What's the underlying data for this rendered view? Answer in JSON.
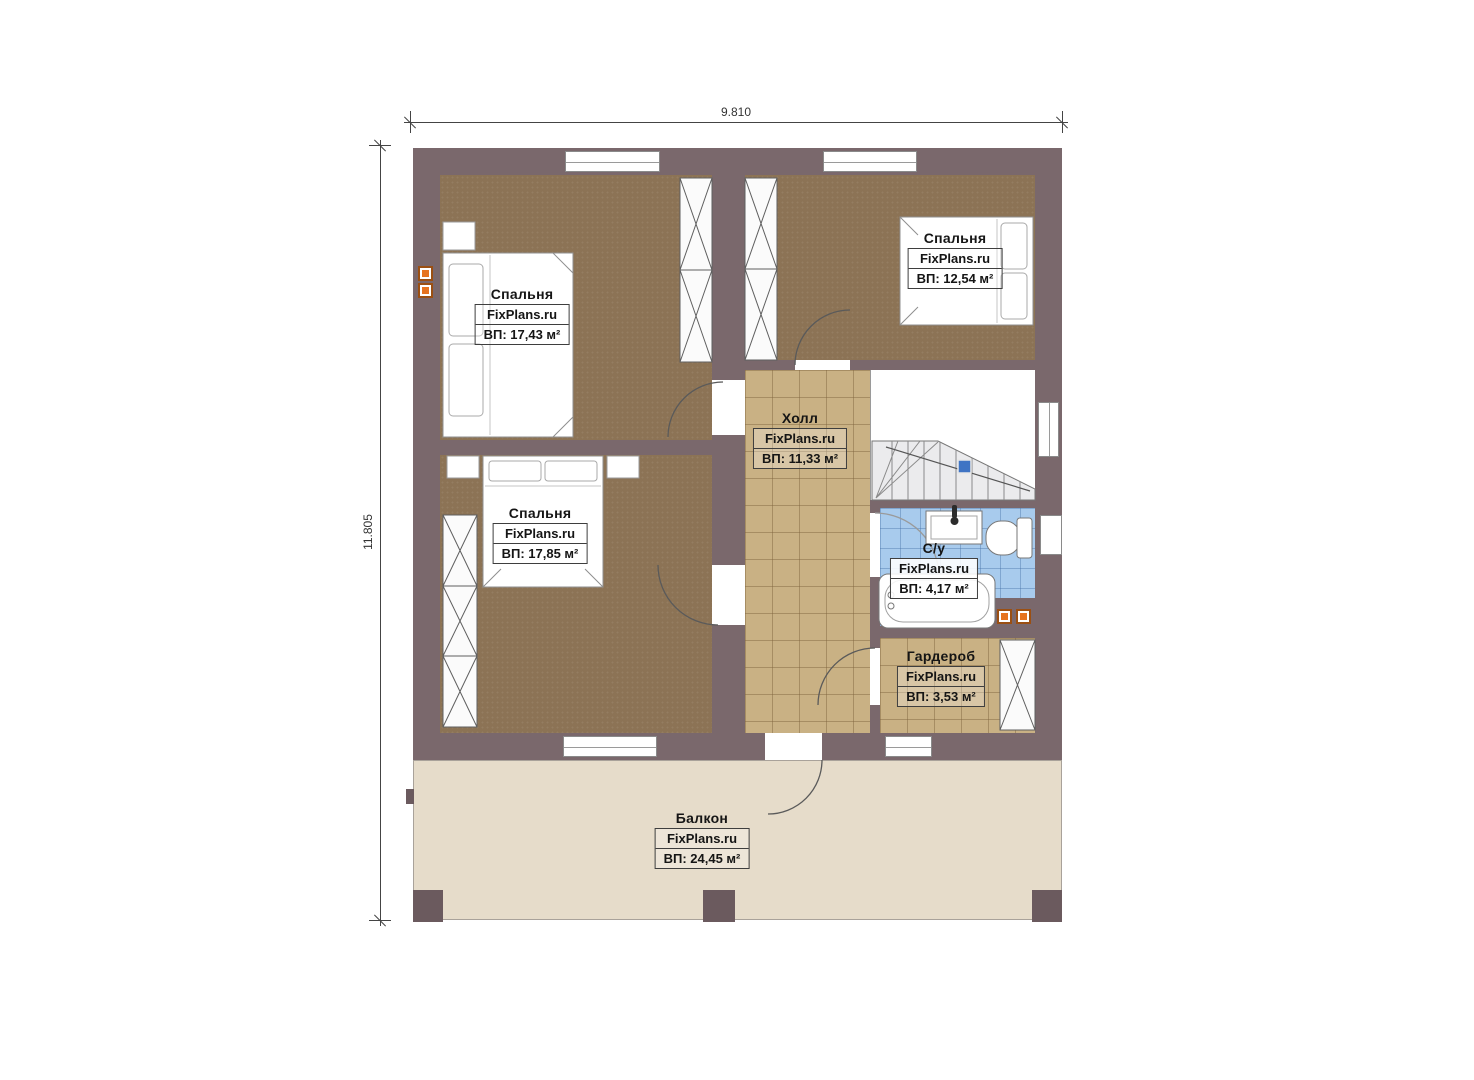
{
  "meta": {
    "drawing_type": "floor plan",
    "width_dimension_label": "9.810",
    "height_dimension_label": "11.805",
    "brand": "FixPlans.ru"
  },
  "rooms": {
    "bedroom_tl": {
      "name": "Спальня",
      "brand": "FixPlans.ru",
      "area": "ВП: 17,43 м²"
    },
    "bedroom_tr": {
      "name": "Спальня",
      "brand": "FixPlans.ru",
      "area": "ВП: 12,54 м²"
    },
    "bedroom_ml": {
      "name": "Спальня",
      "brand": "FixPlans.ru",
      "area": "ВП: 17,85 м²"
    },
    "hall": {
      "name": "Холл",
      "brand": "FixPlans.ru",
      "area": "ВП: 11,33 м²"
    },
    "bathroom": {
      "name": "С/у",
      "brand": "FixPlans.ru",
      "area": "ВП: 4,17 м²"
    },
    "wardrobe": {
      "name": "Гардероб",
      "brand": "FixPlans.ru",
      "area": "ВП: 3,53 м²"
    },
    "balcony": {
      "name": "Балкон",
      "brand": "FixPlans.ru",
      "area": "ВП: 24,45 м²"
    }
  },
  "colors": {
    "wall": "#7a686c",
    "bedroom_floor": "#8c7355",
    "tile_floor": "#c9b184",
    "bathroom_floor": "#a8cbed",
    "balcony_floor": "#e6dcca",
    "vent_orange": "#e6731f",
    "stair_marker_blue": "#3f74c4"
  }
}
